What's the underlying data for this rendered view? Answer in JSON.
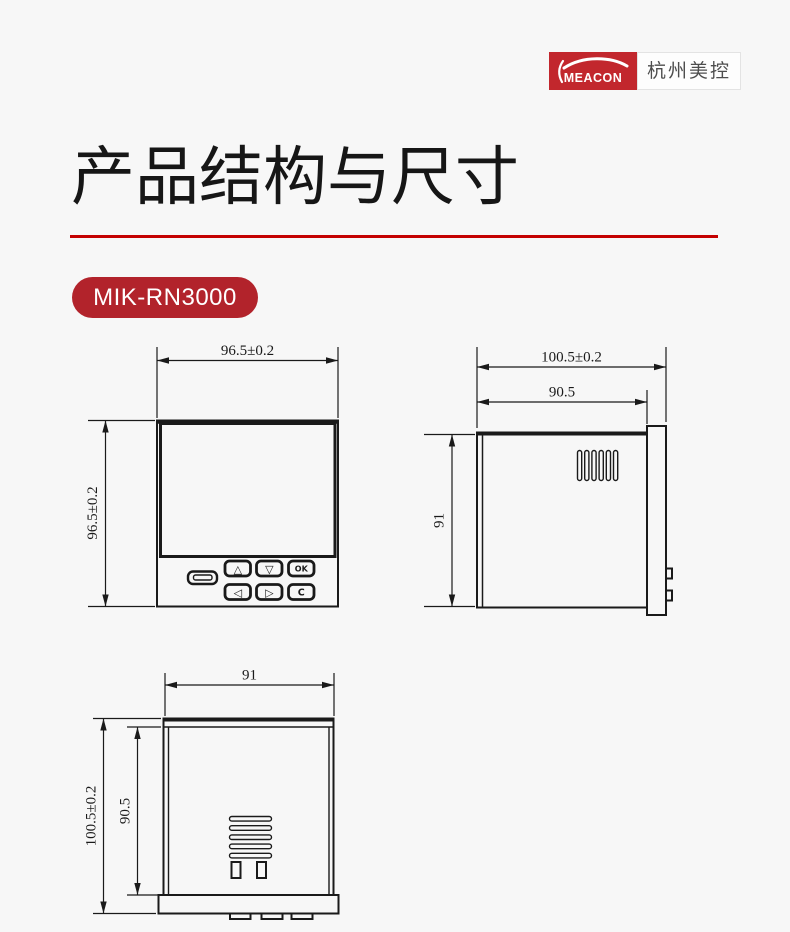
{
  "page": {
    "background": "#f7f7f7",
    "accent_red": "#c40000"
  },
  "logo": {
    "brand": "MEACON",
    "company": "杭州美控",
    "red": "#c2272d"
  },
  "header": {
    "title": "产品结构与尺寸"
  },
  "model_badge": {
    "label": "MIK-RN3000",
    "background": "#b2232b"
  },
  "front_view": {
    "width_dim": "96.5±0.2",
    "height_dim": "96.5±0.2",
    "keys": {
      "up": "△",
      "down": "▽",
      "ok": "OK",
      "left": "◁",
      "right": "▷",
      "clear": "C"
    }
  },
  "side_view": {
    "total_depth_dim": "100.5±0.2",
    "body_depth_dim": "90.5",
    "height_dim": "91"
  },
  "bottom_view": {
    "width_dim": "91",
    "total_depth_dim": "100.5±0.2",
    "body_depth_dim": "90.5"
  }
}
